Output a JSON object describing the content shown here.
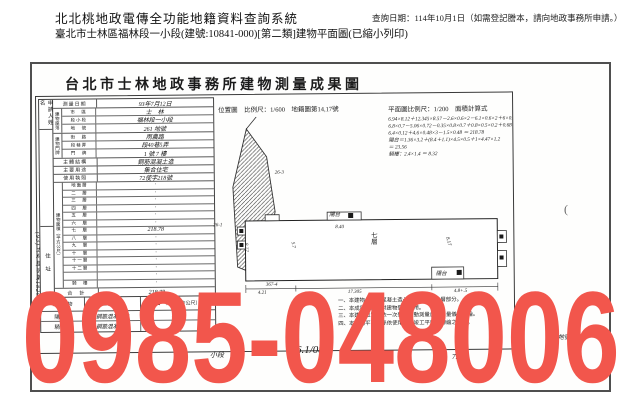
{
  "header": {
    "system_title": "北北桃地政電傳全功能地籍資料查詢系統",
    "query_date": "查詢日期：114年10月1日（如需登記謄本，請向地政事務所申請。）",
    "subtitle": "臺北市士林區福林段一小段(建號:10841-000)[第二類]建物平面圖(已縮小列印)"
  },
  "document": {
    "title": "台北市士林地政事務所建物測量成果圖",
    "stamp": "(93)士林建字第1820號",
    "paren_mark": "(",
    "form": {
      "applicant_label": "申請人姓名",
      "address_label": "住　址",
      "survey_date_label": "測量日期",
      "survey_date": "93年7月12日",
      "location_group_label": "建物座落",
      "location_rows": [
        {
          "label": "市　區",
          "value": "士　林"
        },
        {
          "label": "段小段",
          "value": "福林段一小段"
        },
        {
          "label": "地　號",
          "value": "261 地號"
        }
      ],
      "door_group_label": "建物門牌",
      "door_rows": [
        {
          "label": "街　路",
          "value": "雨農路"
        },
        {
          "label": "段巷弄",
          "value": "段40巷5弄"
        },
        {
          "label": "門　牌",
          "value": "1 號 7 樓"
        }
      ],
      "structure_label": "主體結構",
      "structure": "鋼筋混凝土造",
      "usage_label": "主要用途",
      "usage": "集合住宅",
      "license_label": "使用執照",
      "license": "72使字218號",
      "area_group_label": "建物面積（平方公尺）",
      "floors": [
        {
          "label": "地面層",
          "value": "·"
        },
        {
          "label": "二　層",
          "value": "·"
        },
        {
          "label": "三　層",
          "value": "·"
        },
        {
          "label": "四　層",
          "value": "·"
        },
        {
          "label": "五　層",
          "value": "·"
        },
        {
          "label": "六　層",
          "value": "·"
        },
        {
          "label": "七　層",
          "value": "218.78"
        },
        {
          "label": "八　層",
          "value": "·"
        },
        {
          "label": "九　層",
          "value": "·"
        },
        {
          "label": "十　層",
          "value": "·"
        },
        {
          "label": "十一層",
          "value": "·"
        },
        {
          "label": "十二層",
          "value": "·"
        },
        {
          "label": "　",
          "value": "·"
        },
        {
          "label": "騎　樓",
          "value": "·"
        }
      ],
      "total_label": "合　計",
      "total": "218.78"
    },
    "accessory": {
      "headers": [
        "附屬建物",
        "主體構造",
        "面　積（平方公尺）"
      ],
      "rows": [
        [
          "陽　台",
          "鋼筋混凝土造",
          "23.56"
        ],
        [
          "騎　樓",
          "鋼筋混凝土造",
          "8.32"
        ]
      ]
    },
    "location_map": {
      "label": "位置圖　比例尺：1/600　地籍圖第14,17號",
      "marks": [
        "26-3",
        "26-1",
        "367-4"
      ]
    },
    "plan": {
      "label": "平面圖比例尺：1/200　面積計算式",
      "calc_lines": [
        "6.94×8.12＋12.345×8.57－2.6×0.6×2－6.1×0.6×2＋6×0.5×0.5",
        "6.8×0.7－5.06×0.72－0.35×0.8×0.7＋0.8×0.5×0.2＋0.68",
        "6.4×0.12＋4.6×0.48×3－1.5×0.48 ＝ 218.78",
        "陽台＝1.36×3.2＋(8.4＋1.1)×4.5×0.5＋1×4.47×1.2",
        "＝ 23.56",
        "騎樓：2.4×1.4 ＝ 8.32"
      ],
      "floor_label": "七層",
      "balcony_label_top": "陽台",
      "balcony_label_bottom": "陽台",
      "dims": {
        "top": "8.40",
        "left": "8.12",
        "inner": "5.7",
        "right": "8.17",
        "bottom_left": "4.21",
        "bottom_center": "17.305",
        "bottom_right": "4.8+.5"
      }
    },
    "notes": [
      "一、本建物係鋼筋混凝土造七層房屋之第七層部分。",
      "二、本成果圖係僅供建物登記之用。",
      "三、本建物位置係依一次登記變動測量自動測量儀器測繪。",
      "四、本建物平面圖係依使用執照竣工平面圖轉繪之地號。"
    ],
    "scribbles": [
      "小段",
      "26-/",
      "6.1/08",
      "7.3",
      "地號·"
    ]
  },
  "watermark": {
    "text": "0985-048006",
    "color": "#f2564c"
  }
}
